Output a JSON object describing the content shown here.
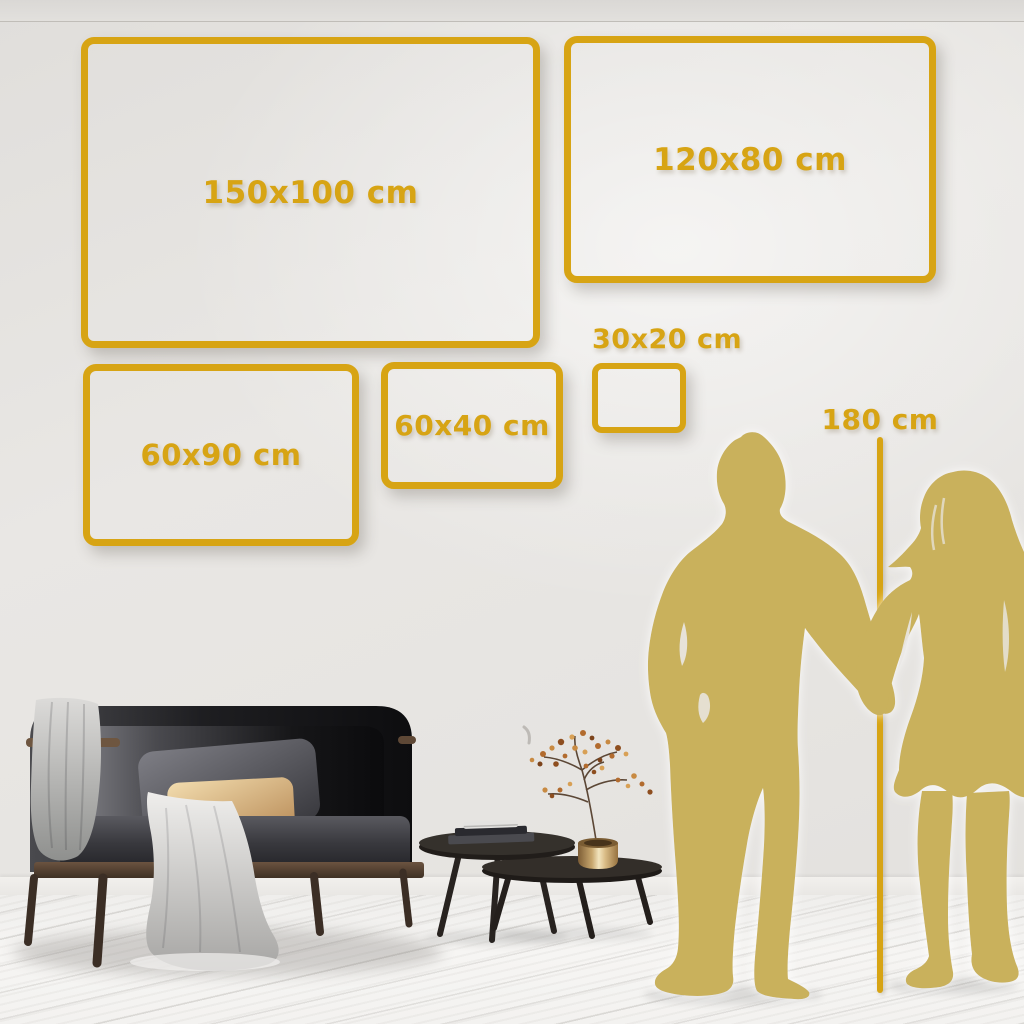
{
  "title_hint": "wall-art size comparison scene",
  "colors": {
    "accent_gold": "#D7A414",
    "silhouette_gold": "#C9B15B",
    "wall": "#E8E6E3",
    "floor": "#F5F4F2"
  },
  "size_boxes": [
    {
      "label": "150x100 cm"
    },
    {
      "label": "120x80 cm"
    },
    {
      "label": "60x90 cm"
    },
    {
      "label": "60x40 cm"
    },
    {
      "label": "30x20 cm"
    }
  ],
  "height_reference": {
    "label": "180 cm"
  },
  "figures": {
    "man_icon": "man-silhouette",
    "woman_icon": "woman-silhouette"
  }
}
